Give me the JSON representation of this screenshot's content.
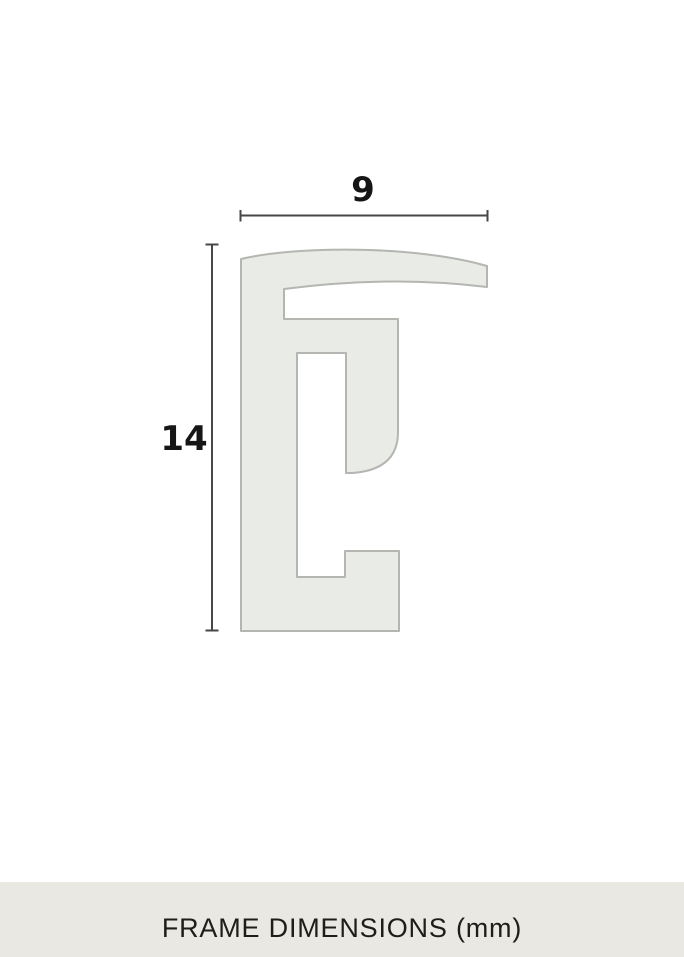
{
  "diagram": {
    "width_label": "9",
    "height_label": "14"
  },
  "footer": {
    "caption": "FRAME DIMENSIONS (mm)"
  },
  "colors": {
    "background": "#ffffff",
    "profile_fill": "#e9ebe6",
    "profile_stroke": "#b5b6b2",
    "dim_line": "#474747",
    "label_text": "#161616",
    "footer_bg": "#e9e8e3",
    "footer_text": "#1d1d1b"
  }
}
